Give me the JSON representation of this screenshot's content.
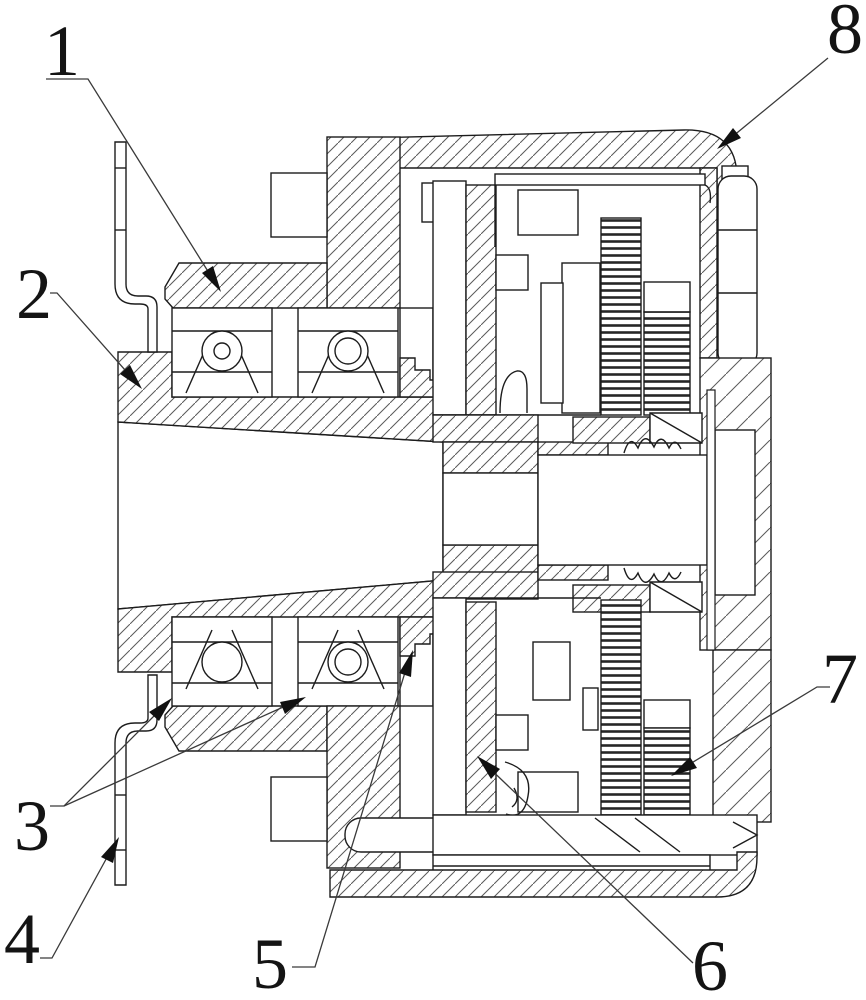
{
  "figure": {
    "kind": "patent sectional engineering drawing",
    "description": "Cross-section of a geared hub / motor assembly with numbered part callouts",
    "background": "#ffffff",
    "line_color": "#1c1c1c",
    "callouts": [
      {
        "label": "1",
        "tx": 62,
        "ty": 75,
        "leader": "46,79 88,79 219,289",
        "arrow": "221,292 202,273 213,266"
      },
      {
        "label": "2",
        "tx": 34,
        "ty": 318,
        "leader": "50,293 57,293 140,387",
        "arrow": "142,389 120,374 130,365"
      },
      {
        "label": "3",
        "tx": 32,
        "ty": 850,
        "leader": "50,806 64,806 168,702",
        "leader2": "64,806 301,699",
        "arrow": "172,698 159,721 149,712",
        "arrow2": "306,697 285,714 280,702"
      },
      {
        "label": "4",
        "tx": 22,
        "ty": 963,
        "leader": "40,958 52,958 116,841",
        "arrow": "119,837 113,863 101,857"
      },
      {
        "label": "5",
        "tx": 270,
        "ty": 988,
        "leader": "292,967 315,967 410,656",
        "arrow": "413,650 411,677 399,673"
      },
      {
        "label": "6",
        "tx": 710,
        "ty": 990,
        "leader": "693,963 481,760",
        "arrow": "477,756 500,769 491,779"
      },
      {
        "label": "7",
        "tx": 840,
        "ty": 703,
        "leader": "830,687 817,687 675,773",
        "arrow": "671,776 690,757 697,768"
      },
      {
        "label": "8",
        "tx": 845,
        "ty": 53,
        "leader": "828,58 721,146",
        "arrow": "717,149 733,128 741,138"
      }
    ]
  }
}
